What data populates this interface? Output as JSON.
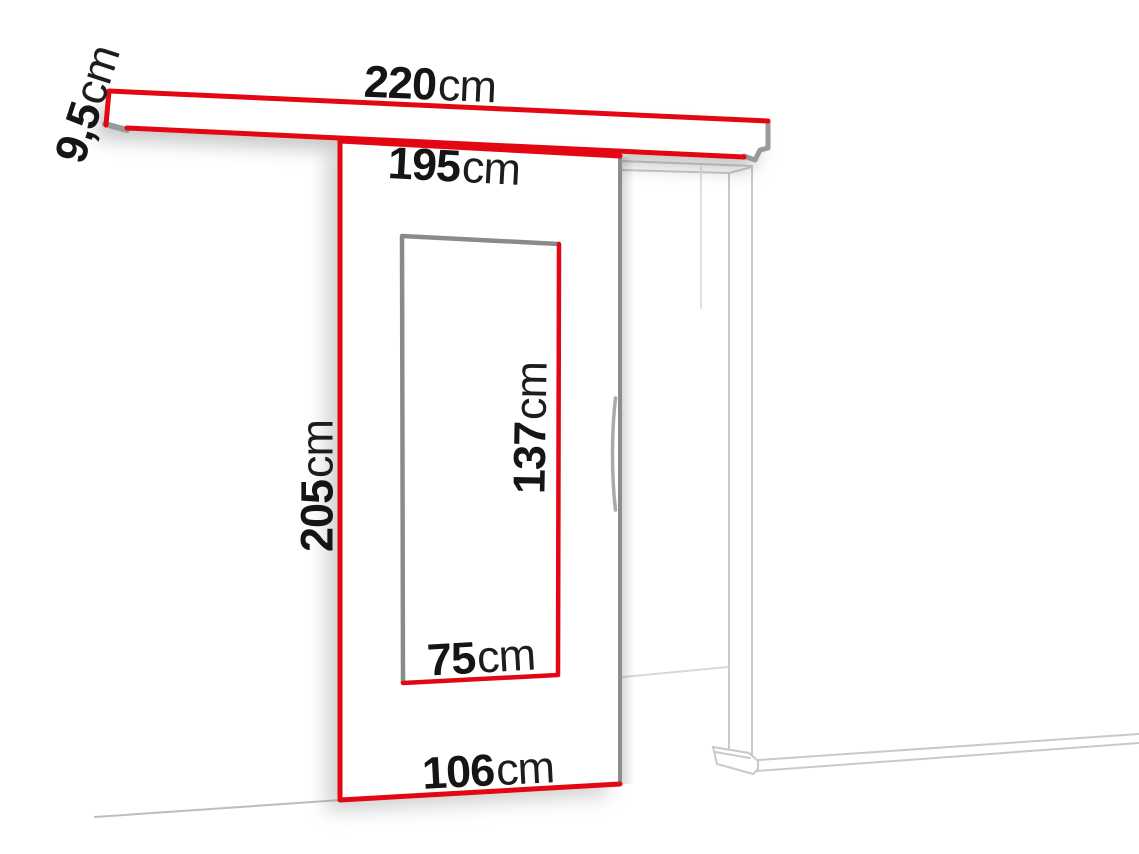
{
  "meta": {
    "description": "Sliding door system dimension diagram"
  },
  "colors": {
    "accent_red": "#e30613",
    "panel_edge_gray": "#8d8d8d",
    "cap_gray": "#9a9a9a",
    "frame_line_gray": "#c9c9c9",
    "label_text": "#151515",
    "background": "#ffffff"
  },
  "dimensions": {
    "track_width": {
      "value": "220",
      "unit": "cm"
    },
    "track_height": {
      "value": "9,5",
      "unit": "cm"
    },
    "passage_width": {
      "value": "195",
      "unit": "cm"
    },
    "door_height": {
      "value": "205",
      "unit": "cm"
    },
    "insert_height": {
      "value": "137",
      "unit": "cm"
    },
    "insert_width": {
      "value": "75",
      "unit": "cm"
    },
    "door_width": {
      "value": "106",
      "unit": "cm"
    }
  }
}
